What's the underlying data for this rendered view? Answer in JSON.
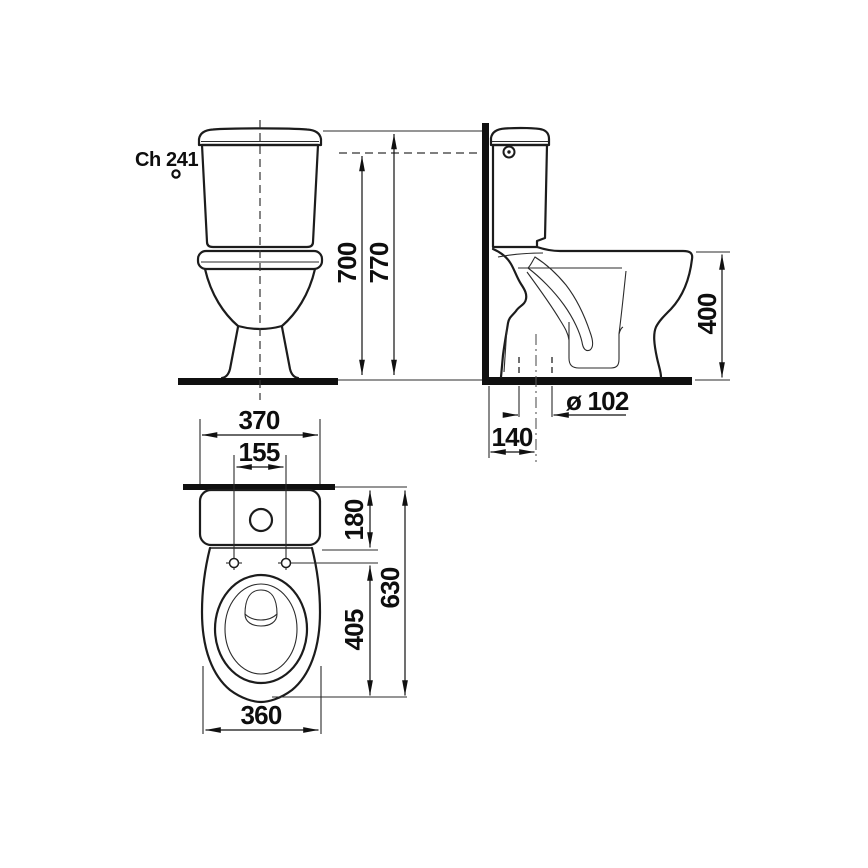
{
  "diagram": {
    "product_code": "Ch 241",
    "front_view": {
      "height_to_cistern_top": "700",
      "height_to_lid_top": "770"
    },
    "side_view": {
      "bowl_height": "400",
      "outlet_diameter": "ø 102",
      "wall_to_outlet_center": "140"
    },
    "top_view": {
      "cistern_width": "370",
      "fixing_holes_spacing": "155",
      "wall_to_hinge_depth": "180",
      "total_depth": "630",
      "hinge_to_front_depth": "405",
      "bowl_width": "360"
    },
    "colors": {
      "line": "#1c1c1c",
      "background": "#ffffff"
    }
  }
}
